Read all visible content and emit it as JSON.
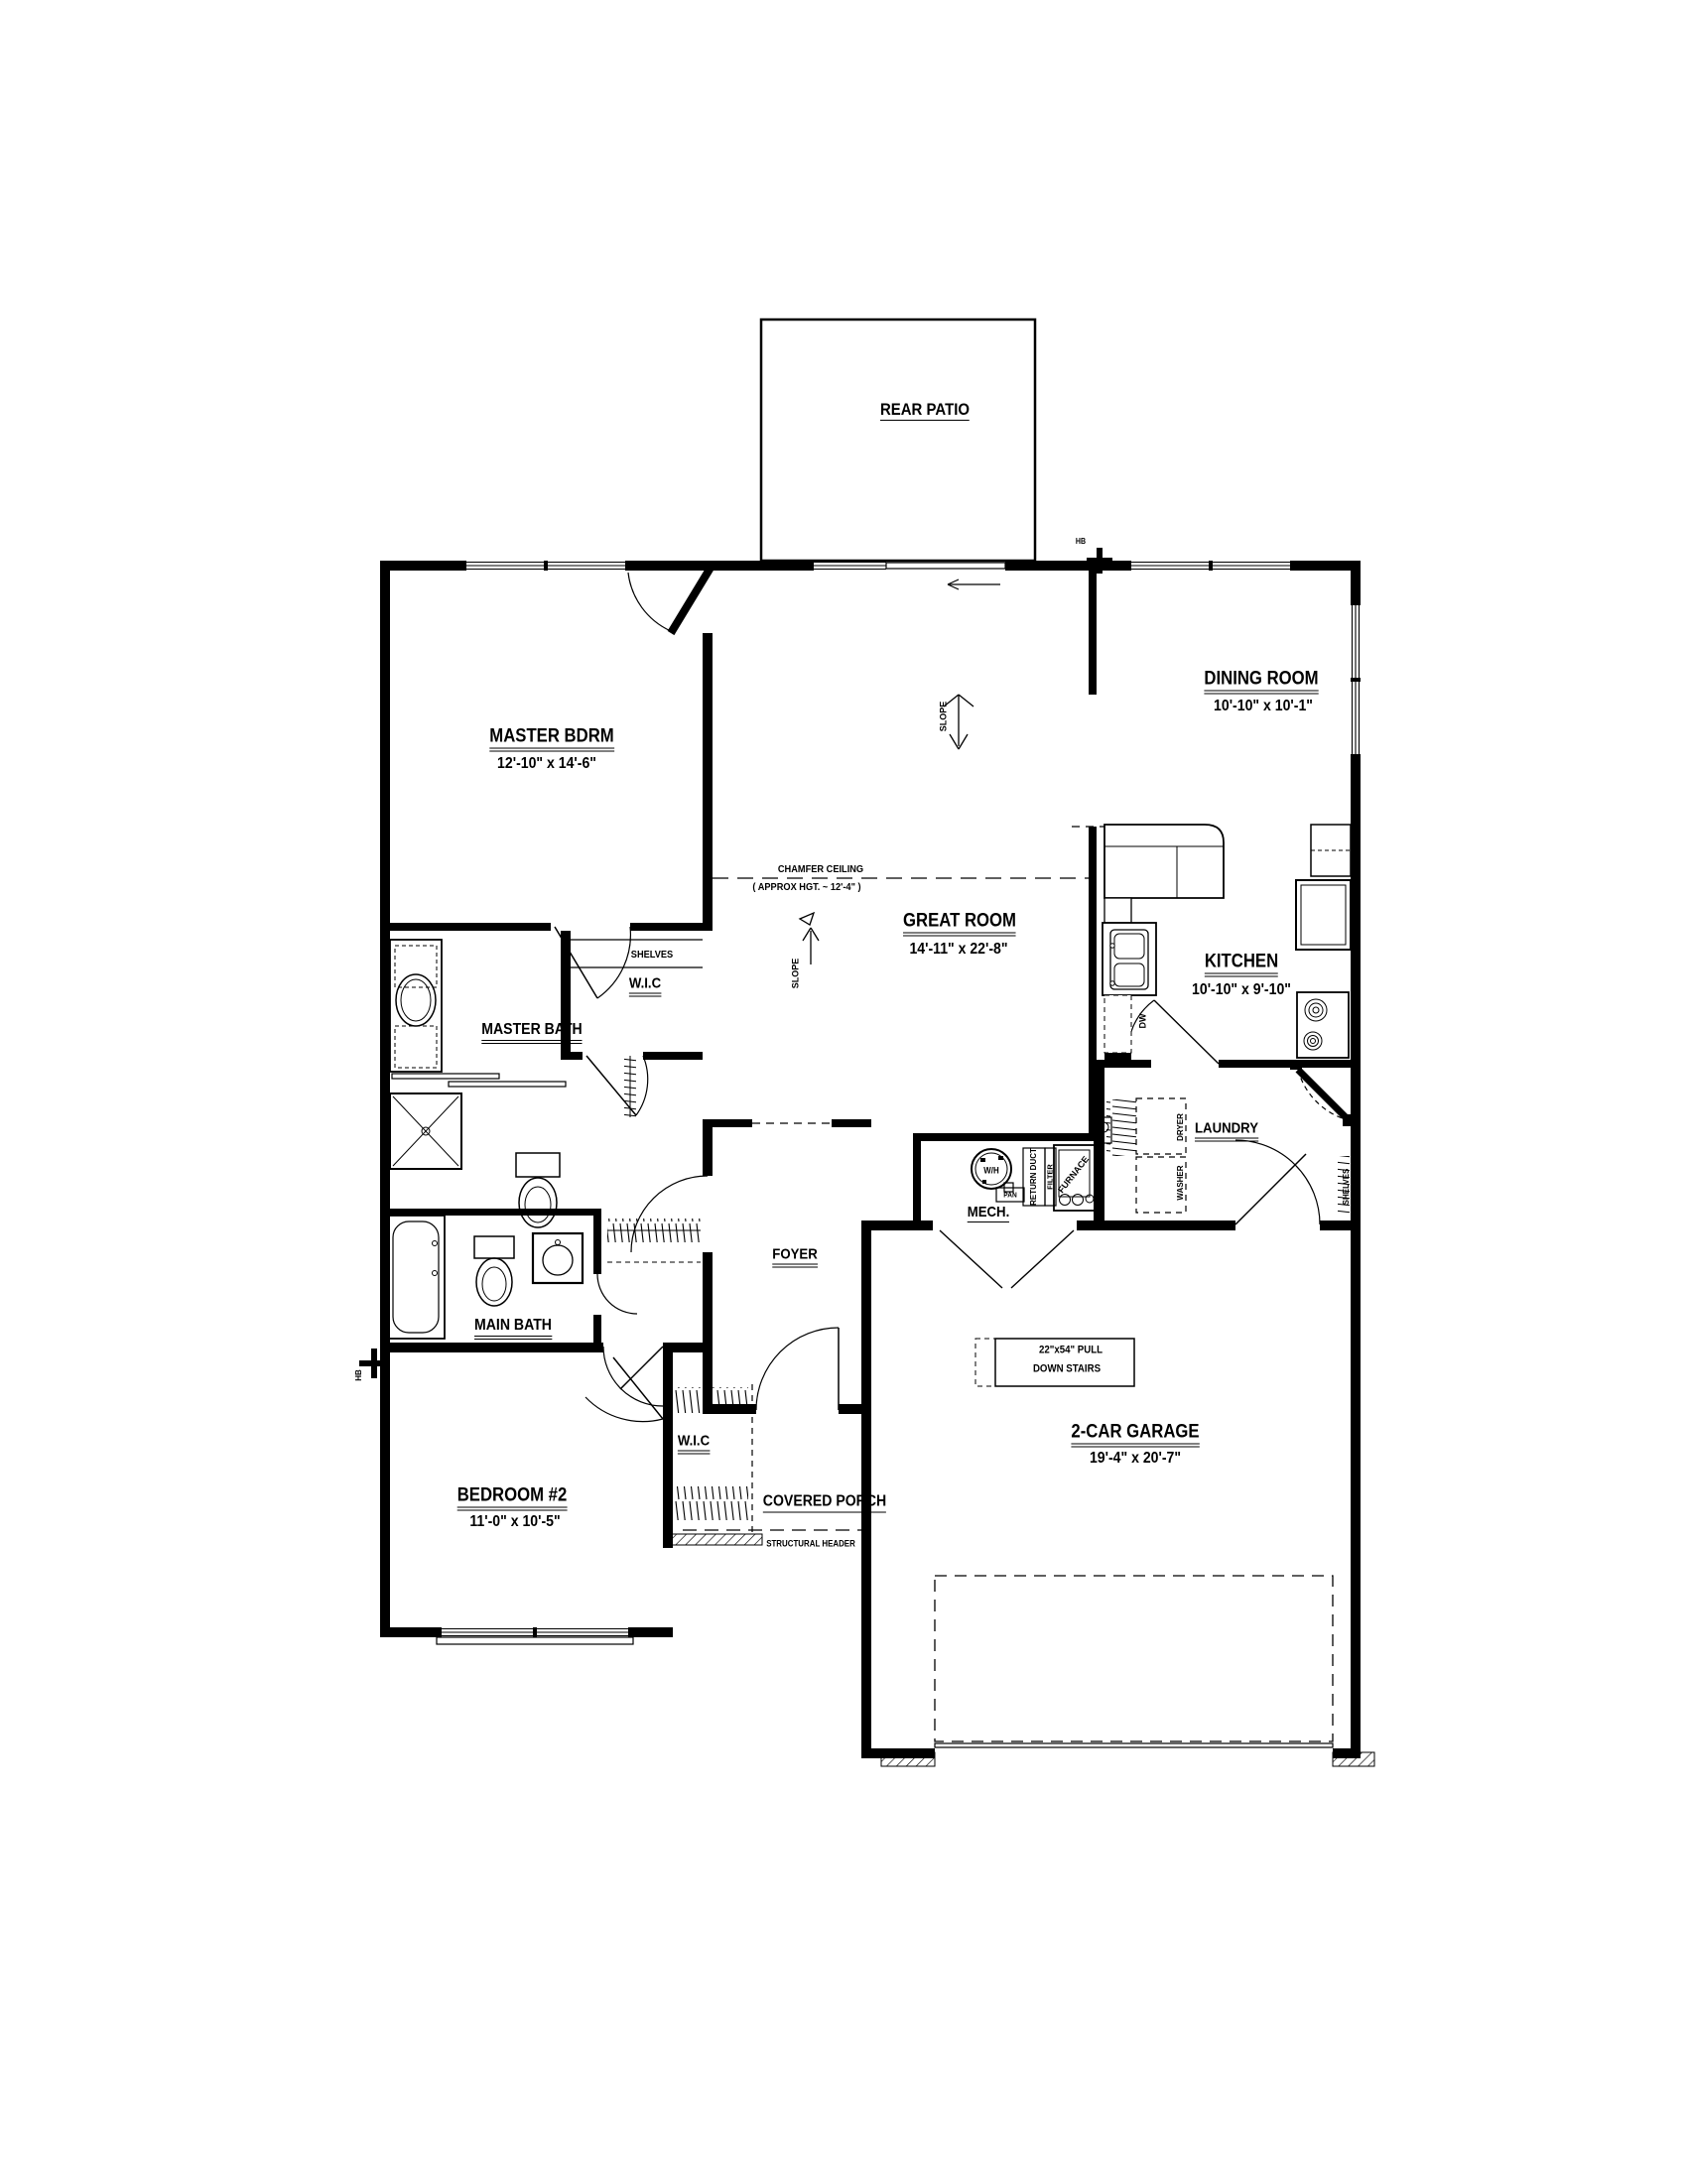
{
  "drawing": {
    "rooms": {
      "rear_patio": {
        "name": "REAR PATIO"
      },
      "master_bdrm": {
        "name": "MASTER BDRM",
        "dims": "12'-10\" x 14'-6\""
      },
      "dining_room": {
        "name": "DINING ROOM",
        "dims": "10'-10\" x 10'-1\""
      },
      "great_room": {
        "name": "GREAT ROOM",
        "dims": "14'-11\" x 22'-8\""
      },
      "kitchen": {
        "name": "KITCHEN",
        "dims": "10'-10\" x 9'-10\""
      },
      "master_bath": {
        "name": "MASTER BATH"
      },
      "wic_master": {
        "name": "W.I.C"
      },
      "laundry": {
        "name": "LAUNDRY"
      },
      "mech": {
        "name": "MECH."
      },
      "foyer": {
        "name": "FOYER"
      },
      "main_bath": {
        "name": "MAIN BATH"
      },
      "bedroom_2": {
        "name": "BEDROOM #2",
        "dims": "11'-0\" x 10'-5\""
      },
      "wic_2": {
        "name": "W.I.C"
      },
      "covered_porch": {
        "name": "COVERED PORCH"
      },
      "garage": {
        "name": "2-CAR GARAGE",
        "dims": "19'-4\" x 20'-7\""
      }
    },
    "annotations": {
      "chamfer_ceiling_1": "CHAMFER CEILING",
      "chamfer_ceiling_2": "( APPROX HGT. ~ 12'-4\" )",
      "shelves_master_wic": "SHELVES",
      "shelves_laundry": "SHELVES",
      "slope_great_room": "SLOPE",
      "slope_hall": "SLOPE",
      "dryer": "DRYER",
      "washer": "WASHER",
      "dishwasher": "DW",
      "water_heater": "W/H",
      "pan": "PAN",
      "return_duct": "RETURN DUCT",
      "filter": "FILTER",
      "furnace": "FURNACE",
      "pull_down_stairs_1": "22\"x54\" PULL",
      "pull_down_stairs_2": "DOWN STAIRS",
      "structural_header": "STRUCTURAL HEADER",
      "hose_bib_top": "HB",
      "hose_bib_left": "HB"
    },
    "colors": {
      "ink": "#000000",
      "paper": "#ffffff"
    }
  }
}
